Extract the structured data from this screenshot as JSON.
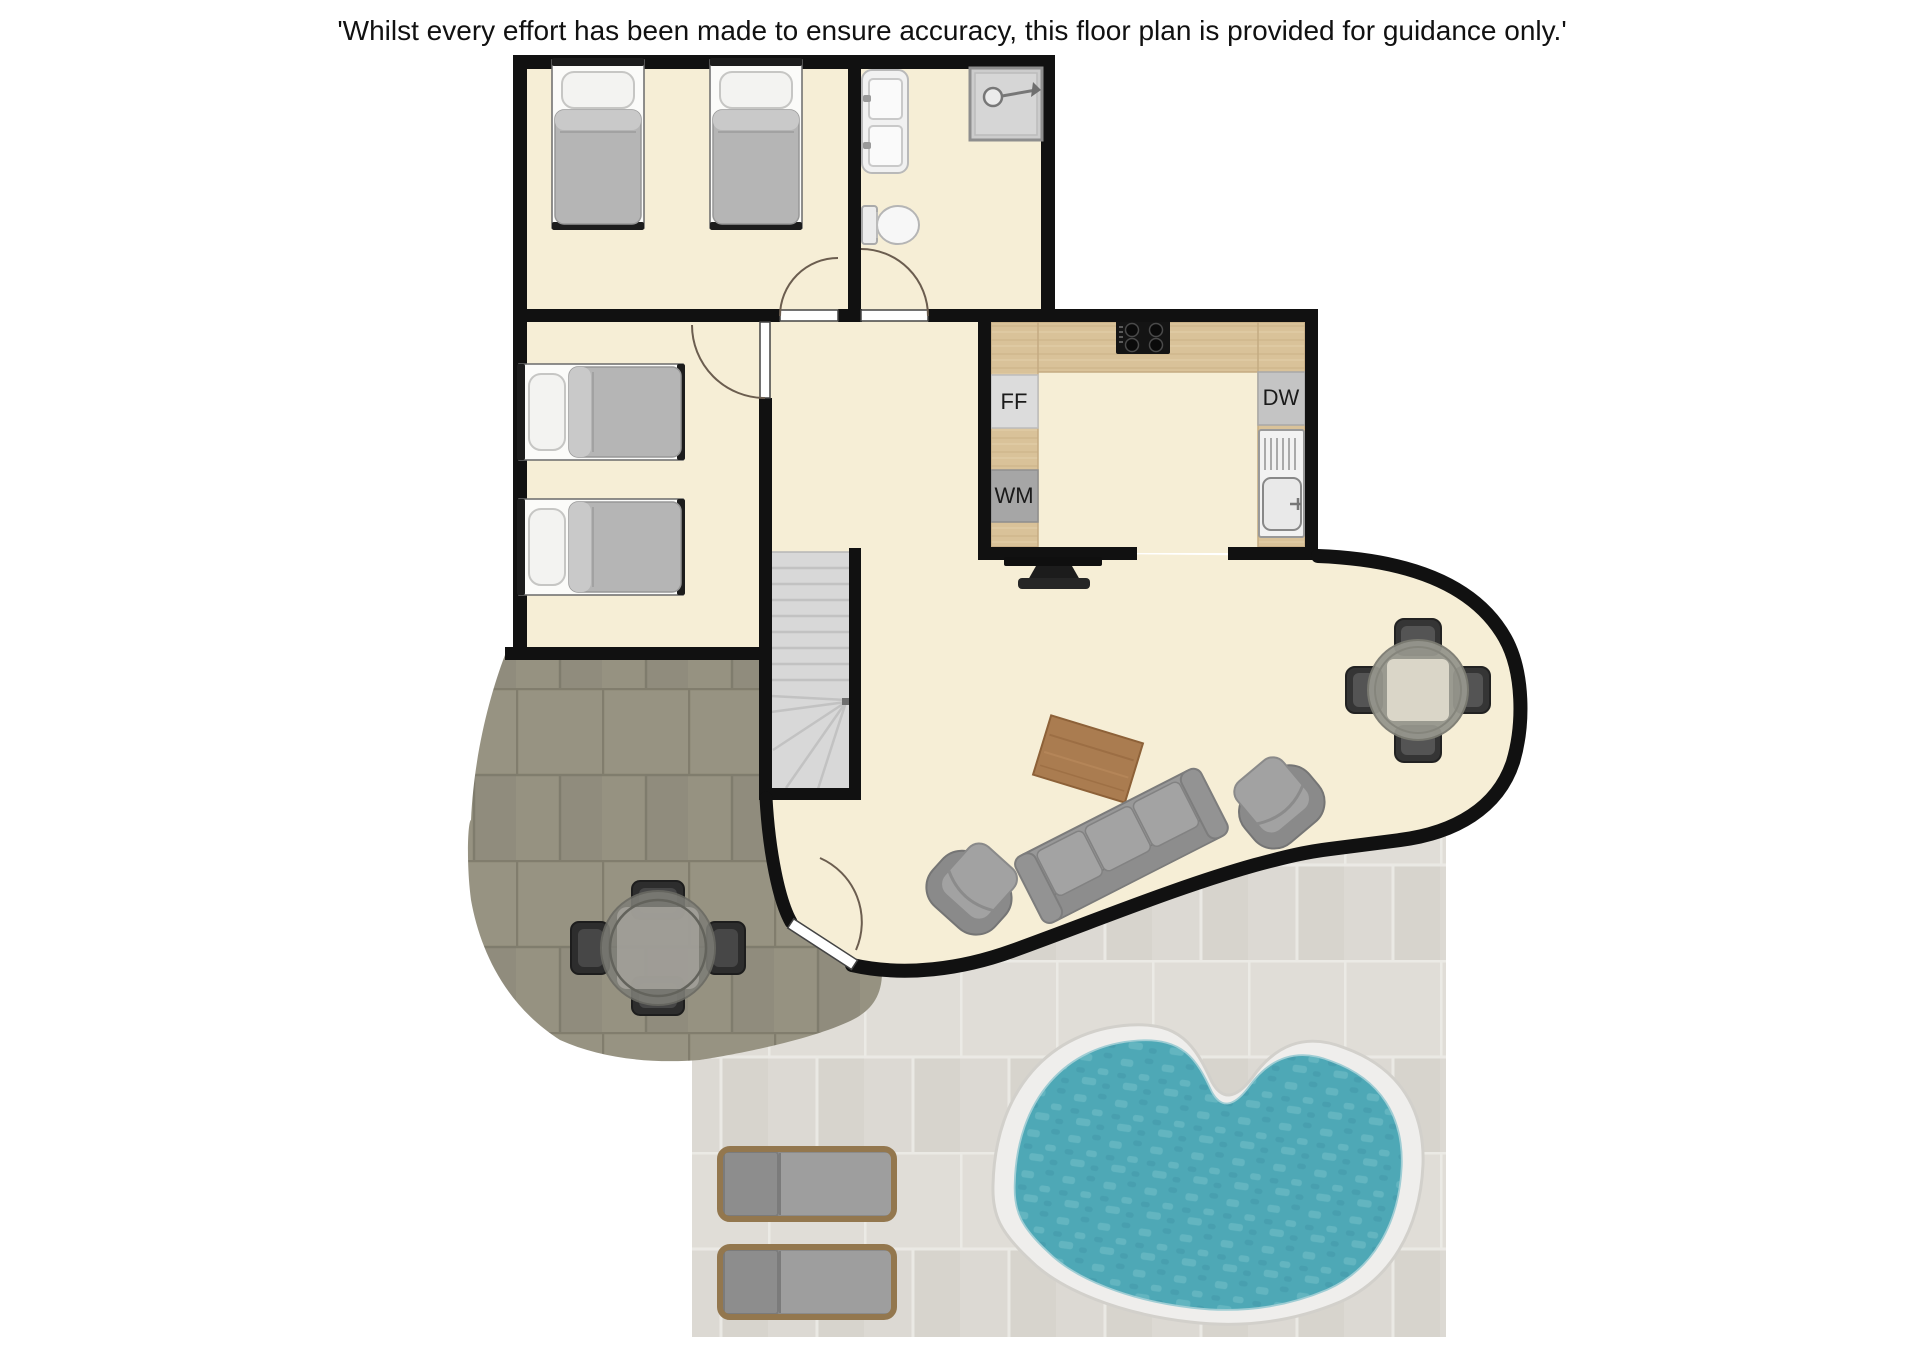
{
  "disclaimer": "'Whilst every effort has been made to ensure accuracy, this floor plan is provided for guidance only.'",
  "labels": {
    "ff": "FF",
    "wm": "WM",
    "dw": "DW"
  },
  "colors": {
    "wall": "#111111",
    "floor": "#f6eed6",
    "counter": "#d9c299",
    "tile_dark": "#949080",
    "tile_light": "#dcd9d3",
    "pool_water": "#4ea8b6",
    "pool_deck": "#efeeec",
    "furniture_grey": "#9d9d9d",
    "wood": "#aa7c50"
  }
}
